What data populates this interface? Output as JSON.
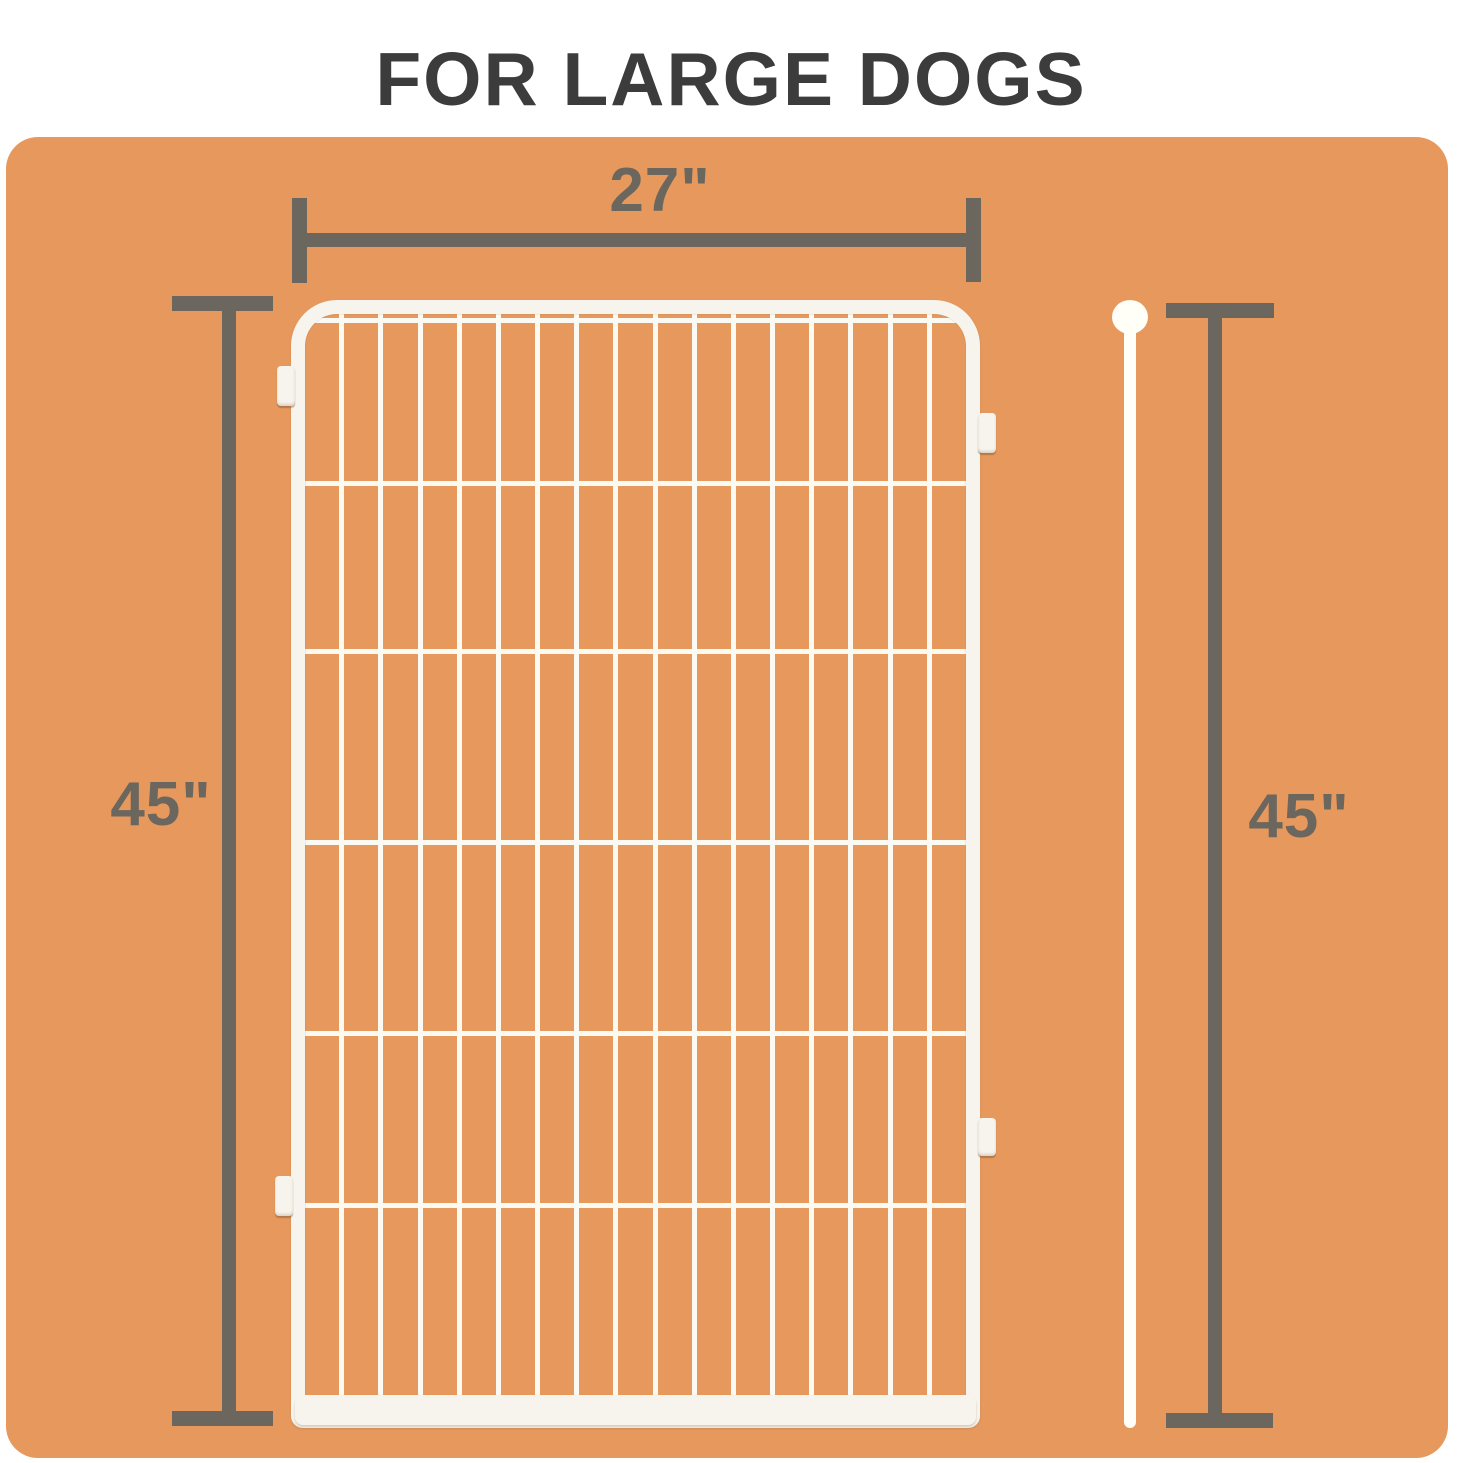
{
  "title": "FOR LARGE DOGS",
  "colors": {
    "page_background": "#ffffff",
    "card_background": "#e6985d",
    "dimension_line": "#6b665e",
    "title_text": "#3c3c3c",
    "panel_frame_white": "#f6f4ec",
    "panel_wire_white": "#fbfaf2",
    "rod_white": "#fffef7"
  },
  "dimensions": {
    "width": {
      "label": "27\""
    },
    "height_left": {
      "label": "45\""
    },
    "height_right": {
      "label": "45\""
    }
  },
  "panel": {
    "vertical_wire_count": 16,
    "horizontal_wire_offsets_px": [
      18,
      181,
      349,
      540,
      731,
      903
    ],
    "connector_tab_count": 4
  }
}
